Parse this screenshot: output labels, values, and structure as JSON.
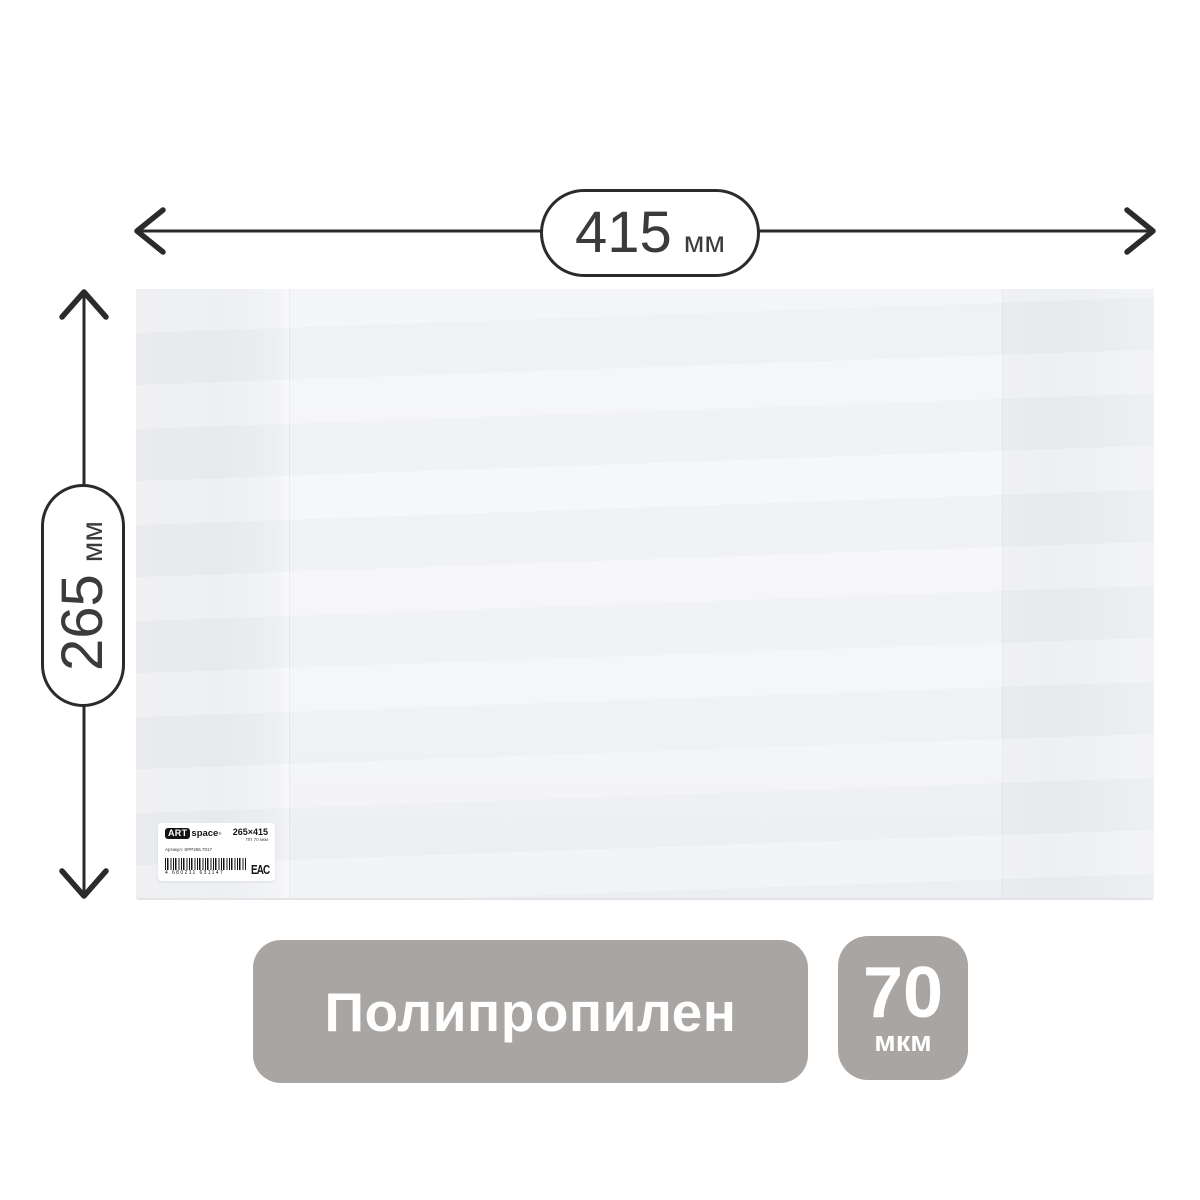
{
  "dimensions": {
    "width": {
      "value": "415",
      "unit": "мм"
    },
    "height": {
      "value": "265",
      "unit": "мм"
    }
  },
  "cover_label": {
    "brand_prefix": "ART",
    "brand_suffix": "space",
    "reg_mark": "®",
    "size": "265×415",
    "spec": "ПП 70 мкм",
    "article": "Артикул: SPP265.7017",
    "barcode": "4 680211 631147",
    "cert_mark": "EAC"
  },
  "badges": {
    "material": "Полипропилен",
    "thickness": {
      "value": "70",
      "unit": "мкм"
    }
  },
  "colors": {
    "annotation": "#2b2b2b",
    "badge-bg": "#a8a5a3",
    "badge-text": "#ffffff",
    "cover-main": "#f4f5f7",
    "cover-flap": "#e9ebee"
  }
}
